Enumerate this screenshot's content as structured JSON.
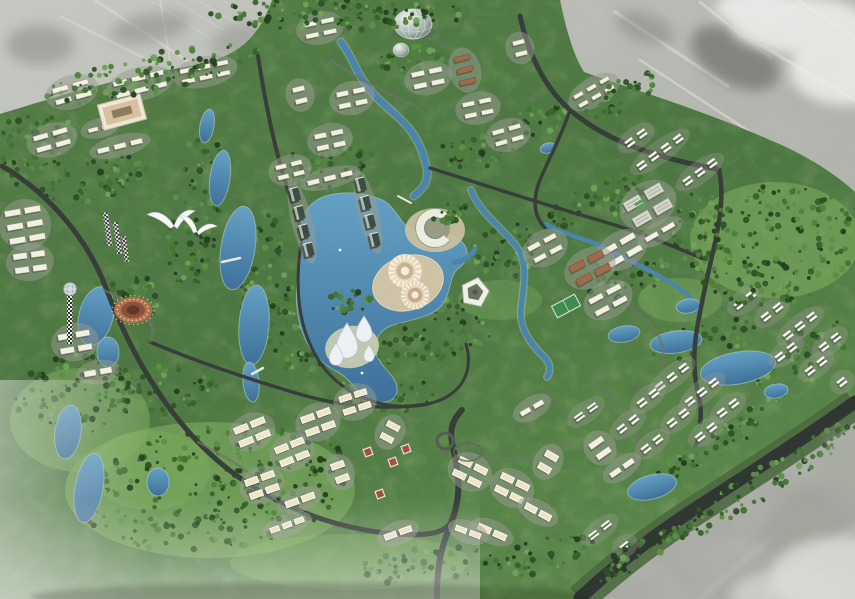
{
  "scene": {
    "type": "aerial-3d-masterplan-rendering",
    "description": "Bird's-eye 3D render of a green master-planned township: tree-covered site with lakes, winding roads, white low-rise clusters, landmark dome, lotus towers and sunburst plazas; surrounding existing terrain shown desaturated grey",
    "visible_text": [],
    "meadows": [
      [
        775,
        240,
        85,
        58,
        0.55
      ],
      [
        210,
        490,
        145,
        68,
        0.6
      ],
      [
        80,
        420,
        70,
        52,
        0.5
      ],
      [
        350,
        562,
        120,
        28,
        0.4
      ],
      [
        500,
        300,
        42,
        20,
        0.35
      ],
      [
        680,
        300,
        42,
        22,
        0.4
      ],
      [
        432,
        250,
        30,
        15,
        0.4
      ],
      [
        150,
        470,
        60,
        40,
        0.45
      ]
    ],
    "forests": [
      [
        340,
        14,
        130,
        16,
        0,
        130,
        1
      ],
      [
        150,
        74,
        115,
        20,
        -12,
        100,
        1
      ],
      [
        28,
        150,
        55,
        35,
        -15,
        70,
        0
      ],
      [
        195,
        210,
        26,
        85,
        8,
        110,
        0
      ],
      [
        262,
        280,
        22,
        70,
        6,
        80,
        0
      ],
      [
        95,
        180,
        55,
        22,
        -12,
        60,
        0
      ],
      [
        330,
        165,
        55,
        25,
        -10,
        60,
        0
      ],
      [
        300,
        330,
        35,
        45,
        0,
        70,
        0
      ],
      [
        440,
        330,
        55,
        30,
        -10,
        70,
        0
      ],
      [
        380,
        395,
        55,
        20,
        -5,
        50,
        0
      ],
      [
        510,
        250,
        40,
        28,
        -15,
        55,
        0
      ],
      [
        600,
        200,
        55,
        22,
        -25,
        55,
        0
      ],
      [
        775,
        245,
        85,
        60,
        -10,
        190,
        1
      ],
      [
        700,
        230,
        30,
        40,
        -10,
        50,
        0
      ],
      [
        768,
        480,
        110,
        16,
        -33,
        80,
        1
      ],
      [
        652,
        545,
        70,
        13,
        -32,
        55,
        1
      ],
      [
        720,
        440,
        80,
        14,
        -33,
        60,
        0
      ],
      [
        215,
        488,
        140,
        62,
        -8,
        300,
        0
      ],
      [
        75,
        395,
        60,
        40,
        -10,
        90,
        0
      ],
      [
        160,
        390,
        60,
        25,
        -12,
        60,
        0
      ],
      [
        430,
        565,
        80,
        18,
        -5,
        60,
        0
      ],
      [
        545,
        555,
        55,
        18,
        -15,
        45,
        0
      ],
      [
        360,
        360,
        40,
        18,
        -10,
        40,
        0
      ],
      [
        630,
        280,
        45,
        16,
        -20,
        45,
        0
      ],
      [
        705,
        340,
        55,
        20,
        -10,
        50,
        0
      ],
      [
        800,
        360,
        55,
        28,
        -38,
        50,
        0
      ],
      [
        622,
        96,
        40,
        16,
        -28,
        40,
        1
      ],
      [
        408,
        58,
        35,
        14,
        -5,
        35,
        0
      ],
      [
        476,
        150,
        40,
        18,
        -10,
        40,
        0
      ],
      [
        352,
        300,
        25,
        12,
        -10,
        25,
        1
      ],
      [
        452,
        212,
        22,
        10,
        -10,
        20,
        1
      ],
      [
        130,
        300,
        35,
        25,
        -10,
        40,
        0
      ],
      [
        540,
        120,
        30,
        15,
        -15,
        30,
        0
      ]
    ],
    "tree_colors": [
      "#223d1d",
      "#2c4f24",
      "#36602b",
      "#417232",
      "#4d8038",
      "#5a8f46"
    ],
    "clusters": [
      [
        72,
        92,
        -16,
        2,
        2,
        16,
        5,
        5,
        7,
        "s"
      ],
      [
        140,
        84,
        -14,
        2,
        3,
        14,
        5,
        5,
        7,
        "s"
      ],
      [
        205,
        72,
        -12,
        2,
        3,
        13,
        4.5,
        5,
        6,
        "s"
      ],
      [
        52,
        140,
        -16,
        2,
        2,
        15,
        5,
        5,
        7,
        "s"
      ],
      [
        120,
        146,
        -14,
        1,
        3,
        12,
        5,
        5,
        7,
        "s"
      ],
      [
        100,
        128,
        -15,
        1,
        2,
        10,
        4,
        4,
        6,
        "s"
      ],
      [
        25,
        225,
        -10,
        3,
        2,
        16,
        6,
        4,
        8,
        "s"
      ],
      [
        30,
        262,
        -8,
        2,
        2,
        14,
        6,
        4,
        8,
        "s"
      ],
      [
        320,
        28,
        -12,
        2,
        2,
        13,
        4.5,
        5,
        7,
        "s"
      ],
      [
        352,
        98,
        -12,
        2,
        2,
        12,
        5,
        5,
        7,
        "s"
      ],
      [
        330,
        140,
        -12,
        2,
        2,
        12,
        5,
        5,
        7,
        "s"
      ],
      [
        300,
        95,
        -14,
        2,
        1,
        12,
        5,
        5,
        7,
        "s"
      ],
      [
        428,
        78,
        -12,
        2,
        2,
        13,
        5,
        5,
        7,
        "s"
      ],
      [
        465,
        70,
        -14,
        3,
        1,
        16,
        5,
        4,
        7,
        "b"
      ],
      [
        478,
        108,
        -12,
        2,
        2,
        12,
        4.5,
        5,
        7,
        "s"
      ],
      [
        520,
        48,
        -14,
        2,
        1,
        12,
        4.5,
        5,
        7,
        "s"
      ],
      [
        508,
        135,
        -16,
        2,
        2,
        12,
        4.5,
        5,
        7,
        "s"
      ],
      [
        594,
        92,
        -30,
        2,
        3,
        10,
        4,
        5,
        6,
        "s"
      ],
      [
        636,
        138,
        -36,
        1,
        2,
        9,
        7,
        6,
        6,
        "p"
      ],
      [
        660,
        152,
        -36,
        1,
        4,
        9,
        7,
        6,
        6,
        "p"
      ],
      [
        700,
        172,
        -36,
        1,
        3,
        9,
        7,
        6,
        6,
        "p"
      ],
      [
        648,
        205,
        -30,
        2,
        2,
        18,
        10,
        6,
        8,
        "h"
      ],
      [
        622,
        250,
        -30,
        2,
        2,
        16,
        6,
        5,
        8,
        "s"
      ],
      [
        590,
        268,
        -28,
        2,
        2,
        16,
        7,
        5,
        8,
        "b"
      ],
      [
        608,
        300,
        -28,
        2,
        2,
        15,
        5.5,
        5,
        8,
        "s"
      ],
      [
        545,
        248,
        -28,
        2,
        2,
        13,
        5,
        5,
        8,
        "s"
      ],
      [
        302,
        222,
        -14,
        4,
        1,
        9,
        13,
        0,
        6,
        "t"
      ],
      [
        368,
        212,
        -14,
        4,
        1,
        9,
        13,
        0,
        6,
        "t"
      ],
      [
        330,
        178,
        -14,
        1,
        3,
        12,
        5,
        5,
        6,
        "s"
      ],
      [
        290,
        170,
        -14,
        2,
        2,
        11,
        4.5,
        5,
        6,
        "s"
      ],
      [
        75,
        342,
        -10,
        2,
        2,
        14,
        6,
        4,
        8,
        "s"
      ],
      [
        98,
        372,
        -10,
        1,
        2,
        12,
        6,
        4,
        8,
        "s"
      ],
      [
        252,
        432,
        -22,
        2,
        2,
        14,
        6,
        4,
        8,
        "c"
      ],
      [
        292,
        452,
        -22,
        2,
        2,
        13,
        6,
        4,
        8,
        "c"
      ],
      [
        318,
        422,
        -20,
        2,
        2,
        13,
        6,
        4,
        8,
        "c"
      ],
      [
        355,
        402,
        -18,
        2,
        2,
        12,
        5.5,
        4,
        8,
        "c"
      ],
      [
        262,
        485,
        -20,
        2,
        2,
        13,
        6,
        4,
        8,
        "c"
      ],
      [
        300,
        500,
        -20,
        1,
        2,
        13,
        6,
        4,
        8,
        "c"
      ],
      [
        340,
        472,
        -20,
        2,
        1,
        13,
        6,
        4,
        8,
        "c"
      ],
      [
        390,
        432,
        28,
        2,
        1,
        13,
        5.5,
        4,
        8,
        "c"
      ],
      [
        287,
        525,
        -20,
        1,
        3,
        9,
        5,
        4,
        7,
        "c"
      ],
      [
        470,
        472,
        26,
        2,
        2,
        13,
        6,
        4,
        8,
        "c"
      ],
      [
        512,
        488,
        26,
        2,
        2,
        13,
        6,
        4,
        8,
        "c"
      ],
      [
        548,
        462,
        30,
        2,
        1,
        13,
        6,
        4,
        8,
        "c"
      ],
      [
        492,
        532,
        24,
        1,
        2,
        13,
        6,
        4,
        8,
        "c"
      ],
      [
        538,
        512,
        28,
        1,
        2,
        12,
        6,
        4,
        8,
        "c"
      ],
      [
        398,
        533,
        -20,
        1,
        2,
        12,
        5.5,
        4,
        8,
        "c"
      ],
      [
        468,
        532,
        20,
        1,
        2,
        11,
        5,
        4,
        8,
        "c"
      ],
      [
        532,
        408,
        -30,
        1,
        2,
        11,
        5,
        4,
        8,
        "s"
      ],
      [
        672,
        377,
        -38,
        1,
        3,
        9,
        7,
        6,
        6,
        "p"
      ],
      [
        702,
        392,
        -38,
        1,
        3,
        9,
        7,
        6,
        6,
        "p"
      ],
      [
        728,
        408,
        -38,
        1,
        2,
        9,
        7,
        6,
        6,
        "p"
      ],
      [
        648,
        398,
        -38,
        1,
        2,
        9,
        7,
        6,
        6,
        "p"
      ],
      [
        678,
        418,
        -38,
        1,
        2,
        9,
        7,
        6,
        6,
        "p"
      ],
      [
        706,
        432,
        -38,
        1,
        2,
        9,
        7,
        6,
        6,
        "p"
      ],
      [
        628,
        424,
        -38,
        1,
        2,
        9,
        7,
        6,
        6,
        "p"
      ],
      [
        652,
        444,
        -38,
        1,
        2,
        9,
        7,
        6,
        6,
        "p"
      ],
      [
        586,
        412,
        -36,
        1,
        2,
        10,
        6,
        6,
        6,
        "p"
      ],
      [
        600,
        448,
        -35,
        2,
        1,
        16,
        6,
        4,
        7,
        "s"
      ],
      [
        622,
        468,
        -35,
        1,
        2,
        12,
        5.5,
        4,
        7,
        "s"
      ],
      [
        745,
        300,
        -38,
        1,
        2,
        9,
        7,
        6,
        6,
        "p"
      ],
      [
        772,
        312,
        -38,
        1,
        2,
        9,
        7,
        6,
        6,
        "p"
      ],
      [
        800,
        326,
        -38,
        1,
        3,
        9,
        7,
        6,
        6,
        "p"
      ],
      [
        830,
        342,
        -38,
        1,
        2,
        9,
        7,
        6,
        6,
        "p"
      ],
      [
        786,
        352,
        -38,
        1,
        2,
        9,
        7,
        6,
        6,
        "p"
      ],
      [
        816,
        366,
        -38,
        1,
        2,
        9,
        7,
        6,
        6,
        "p"
      ],
      [
        842,
        382,
        -38,
        1,
        1,
        9,
        7,
        6,
        6,
        "p"
      ],
      [
        600,
        530,
        -38,
        1,
        2,
        10,
        6,
        6,
        6,
        "p"
      ],
      [
        625,
        546,
        -38,
        1,
        1,
        10,
        6,
        6,
        6,
        "p"
      ],
      [
        660,
        232,
        -30,
        1,
        2,
        14,
        5,
        5,
        7,
        "s"
      ]
    ],
    "pavilions": [
      [
        368,
        452
      ],
      [
        393,
        462
      ],
      [
        380,
        494
      ],
      [
        406,
        449
      ]
    ],
    "boats": [
      [
        362,
        373
      ],
      [
        340,
        250
      ]
    ]
  },
  "palette": {
    "context_gray": "#b4b6b0",
    "site_green": "#507b40",
    "site_dark": "#3f6234",
    "meadow": "#7fae5f",
    "water": "#4a84ab",
    "water_deep": "#3c6f99",
    "shore": "#a9c9c2",
    "road": "#353c37",
    "road_major": "#2e3531",
    "pavement": "#989c90",
    "bldg_white": "#f3f1e3",
    "bldg_cream": "#efe5c6",
    "bldg_brick": "#9b6b4b",
    "bldg_hall": "#d7dacd",
    "tower_dark": "#3c4a42",
    "sand": "#cfc3a6",
    "amphitheater": "#b16f4c",
    "fog": "#e9eae6"
  }
}
